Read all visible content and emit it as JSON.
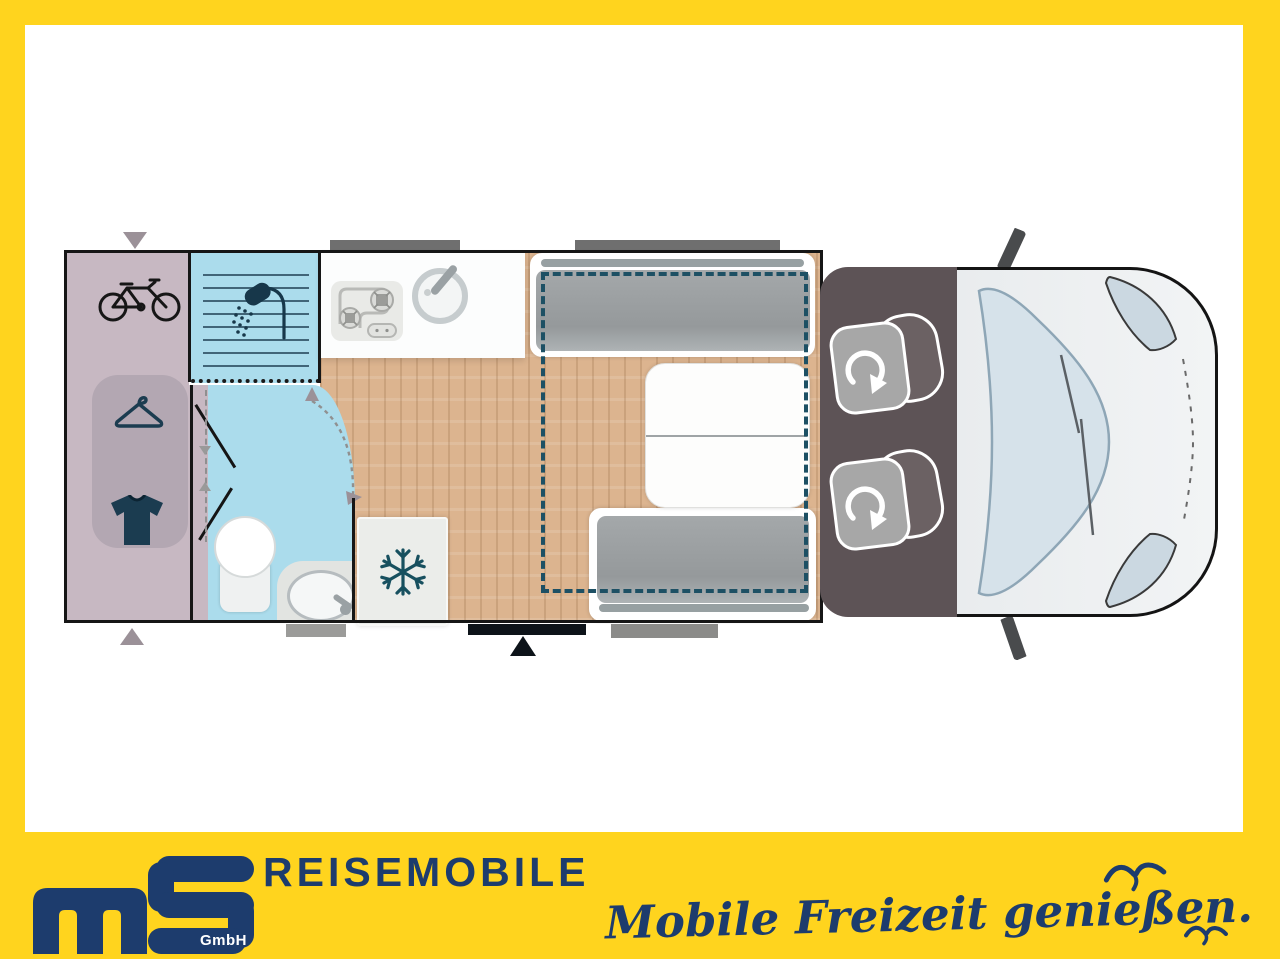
{
  "branding": {
    "logo_monogram": "ms",
    "logo_suffix": "GmbH",
    "wordmark": "REISEMOBILE",
    "slogan": "Mobile Freizeit genießen."
  },
  "colors": {
    "frame_yellow": "#FFD41E",
    "brand_navy": "#1D3C6D",
    "floor_wood": "#DCB48F",
    "garage_mauve": "#C7B8C2",
    "wardrobe_mauve": "#B3A7B2",
    "wet_room_blue": "#ABDCEC",
    "bed_dash_teal": "#1D5064",
    "cab_gray": "#5D5356",
    "cushion_gray": "#9DA1A3",
    "icon_teal": "#1B3C50"
  },
  "floorplan": {
    "type": "motorhome top-down layout",
    "zones": [
      {
        "name": "rear-garage",
        "features": [
          "bicycle storage",
          "wardrobe with hanger",
          "clothes storage"
        ]
      },
      {
        "name": "shower-cubicle",
        "features": [
          "shower"
        ]
      },
      {
        "name": "bathroom",
        "features": [
          "toilet",
          "washbasin"
        ]
      },
      {
        "name": "kitchen",
        "features": [
          "2-burner hob",
          "round sink",
          "refrigerator"
        ]
      },
      {
        "name": "dinette",
        "features": [
          "two bench seats",
          "extendable table",
          "drop-down bed (dashed outline)"
        ]
      },
      {
        "name": "cab",
        "features": [
          "two swivel seats",
          "windshield",
          "mirrors"
        ]
      }
    ],
    "icons": [
      {
        "name": "bicycle-icon"
      },
      {
        "name": "hanger-icon"
      },
      {
        "name": "tshirt-icon"
      },
      {
        "name": "shower-icon"
      },
      {
        "name": "snowflake-icon"
      },
      {
        "name": "rotating-seat-icon"
      },
      {
        "name": "seagull-icon"
      }
    ]
  }
}
